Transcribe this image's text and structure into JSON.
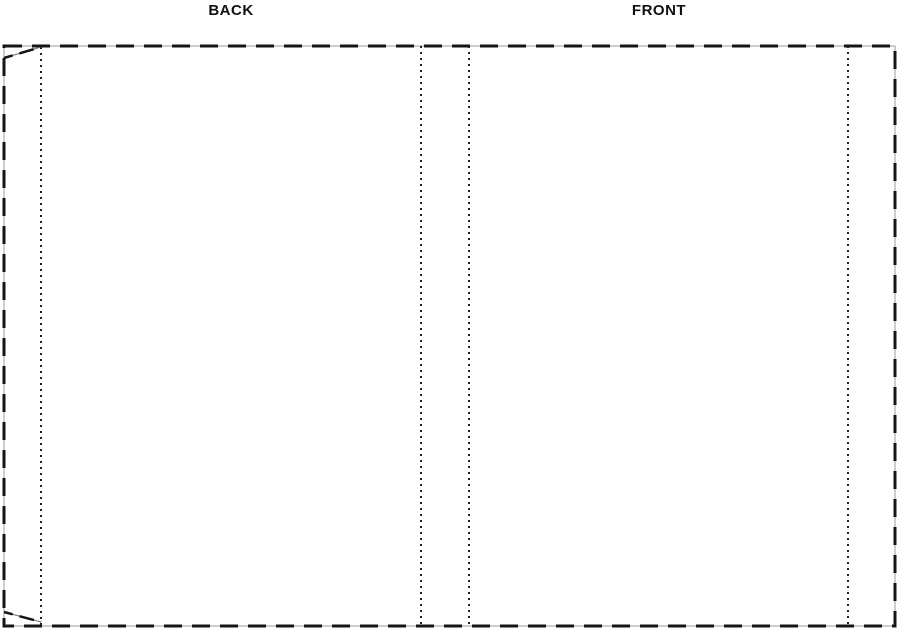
{
  "labels": {
    "back": "BACK",
    "front": "FRONT"
  },
  "colors": {
    "background": "#ffffff",
    "cut_dash": "#151515",
    "guide_gray": "#9b9b9b",
    "fold_dot": "#222222",
    "taper_line": "#6e6e6e",
    "label_text": "#111111"
  }
}
